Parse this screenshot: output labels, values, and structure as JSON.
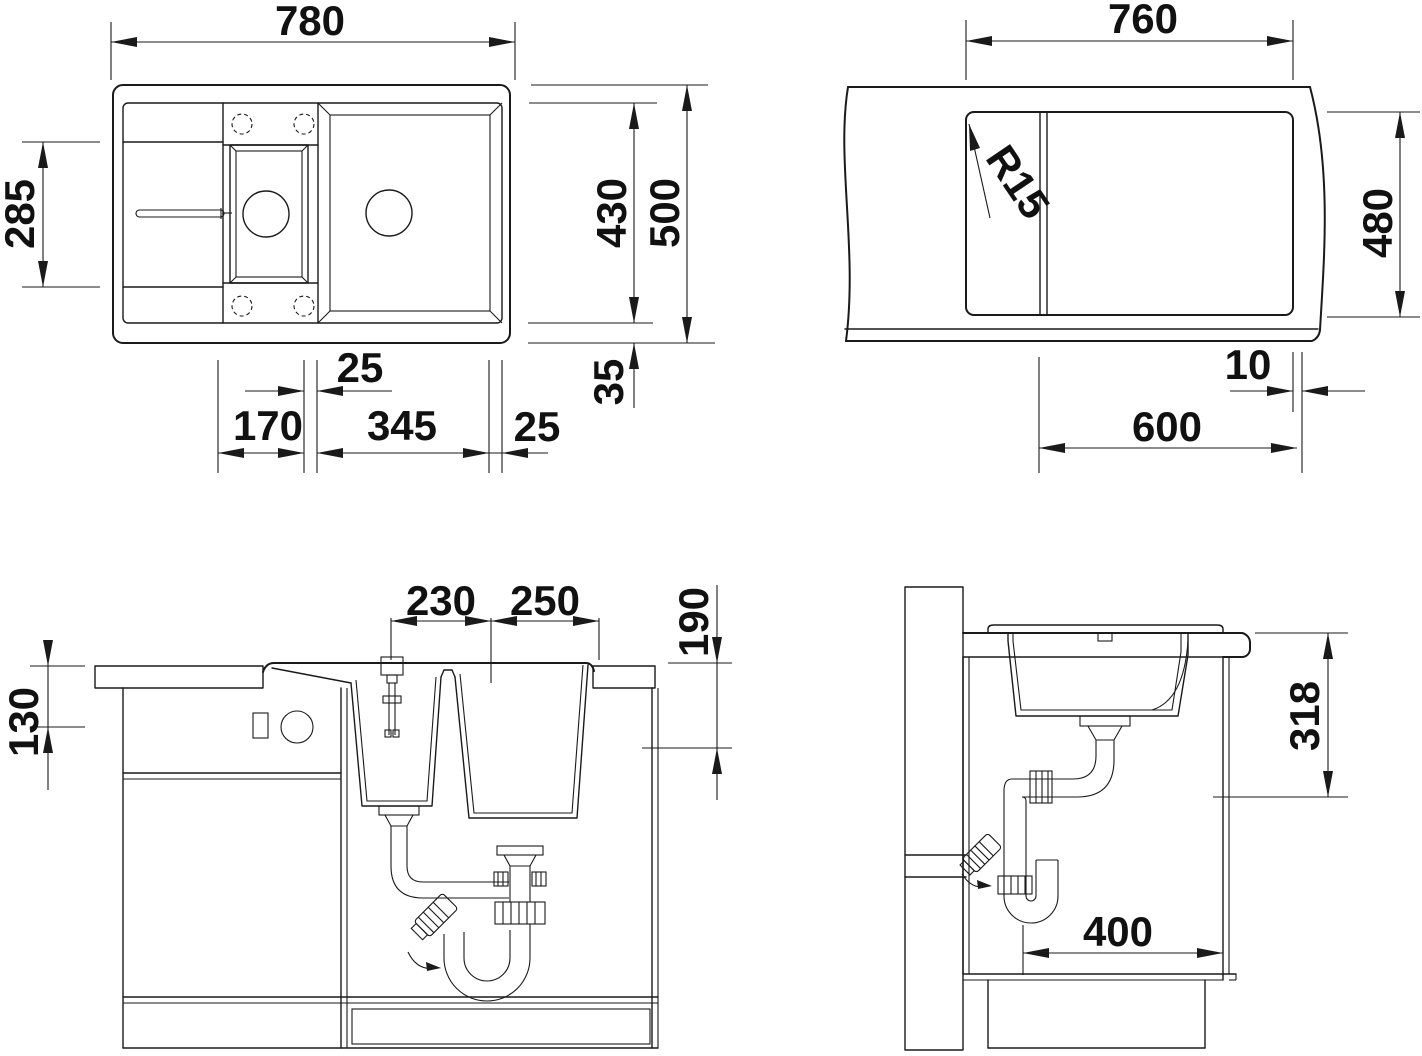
{
  "drawing": {
    "type": "kitchen sink installation dimensional drawing",
    "colors": {
      "line": "#1a1a1a",
      "background": "#ffffff"
    },
    "views": {
      "plan": {
        "label": "sink-top-view",
        "dims": {
          "overall_width": "780",
          "drainer_length": "285",
          "inner_length": "430",
          "overall_depth": "500",
          "rim_edge": "35",
          "bowl_gap": "25",
          "small_bowl_width": "170",
          "large_bowl_width": "345",
          "right_margin": "25"
        }
      },
      "cutout": {
        "label": "countertop-cutout-view",
        "dims": {
          "cutout_width": "760",
          "cutout_depth": "480",
          "corner_radius": "R15",
          "front_offset": "10",
          "cabinet_width": "600"
        }
      },
      "front": {
        "label": "front-section-view",
        "dims": {
          "tap_to_center": "230",
          "center_to_edge": "250",
          "bowl_depth": "190",
          "control_height": "130"
        }
      },
      "side": {
        "label": "side-section-view",
        "dims": {
          "drain_outlet_height": "318",
          "clearance_depth": "400"
        }
      }
    }
  }
}
